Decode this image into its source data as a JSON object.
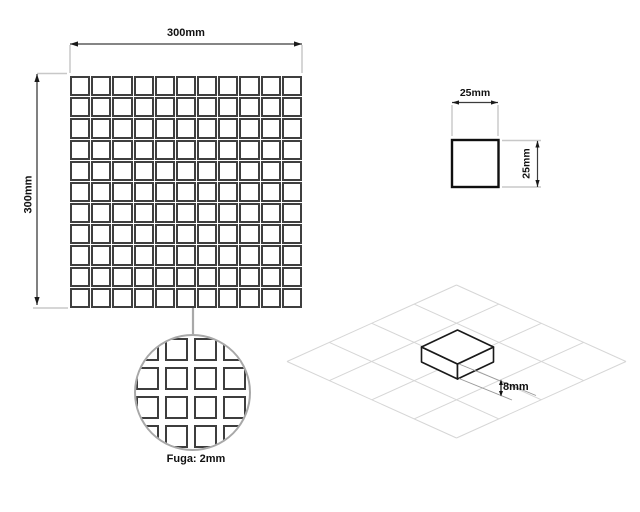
{
  "drawing": {
    "panel": {
      "width_label": "300mm",
      "height_label": "300mm",
      "rows": 11,
      "cols": 11,
      "tile_count": 121
    },
    "single_tile": {
      "width_label": "25mm",
      "height_label": "25mm"
    },
    "detail": {
      "label": "Fuga: 2mm",
      "cols": 6,
      "tile_count": 36
    },
    "iso_view": {
      "thickness_label": "8mm"
    },
    "colors": {
      "tile_border": "#3f3f3f",
      "dimension_line": "#3c3c3c",
      "extension_line": "#c8c8c8",
      "leader_gray": "#a8a8a8",
      "iso_grid_line": "#d6d6d6",
      "box_line": "#1a1a1a",
      "text": "#111111"
    }
  }
}
